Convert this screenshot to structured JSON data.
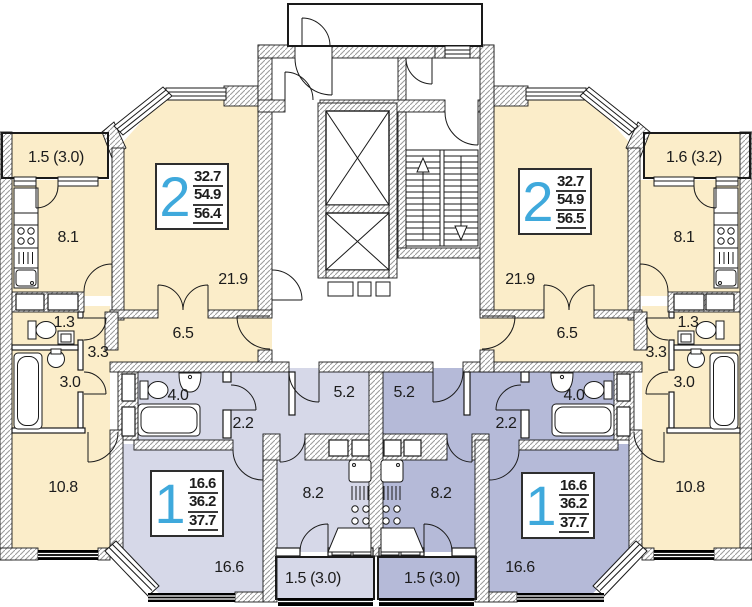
{
  "colors": {
    "apartment_2room": "#FBEDC9",
    "apartment_1room_left": "#D6D8E8",
    "apartment_1room_right": "#B5BAD8",
    "apartment_number_blue": "#3FA9DC"
  },
  "apartments": [
    {
      "id": "two-room-left",
      "rooms_count": "2",
      "area_living": "32.7",
      "area_usable": "54.9",
      "area_total": "56.4"
    },
    {
      "id": "two-room-right",
      "rooms_count": "2",
      "area_living": "32.7",
      "area_usable": "54.9",
      "area_total": "56.5"
    },
    {
      "id": "one-room-left",
      "rooms_count": "1",
      "area_living": "16.6",
      "area_usable": "36.2",
      "area_total": "37.7"
    },
    {
      "id": "one-room-right",
      "rooms_count": "1",
      "area_living": "16.6",
      "area_usable": "36.2",
      "area_total": "37.7"
    }
  ],
  "labels": {
    "balcony_top_left": "1.5 (3.0)",
    "kitchen_top_left": "8.1",
    "living_top_left": "21.9",
    "hallway_top_left": "6.5",
    "wc_top_left": "1.3",
    "corridor_top_left": "3.3",
    "bathroom_top_left": "3.0",
    "room_bottom_left": "10.8",
    "bathroom_1room_left": "4.0",
    "hall_1room_left": "2.2",
    "entry_1room_left": "5.2",
    "kitchen_1room_left": "8.2",
    "room_1room_left": "16.6",
    "balcony_1room_left": "1.5 (3.0)",
    "balcony_top_right": "1.6 (3.2)",
    "kitchen_top_right": "8.1",
    "living_top_right": "21.9",
    "hallway_top_right": "6.5",
    "wc_top_right": "1.3",
    "corridor_top_right": "3.3",
    "bathroom_top_right": "3.0",
    "room_bottom_right": "10.8",
    "bathroom_1room_right": "4.0",
    "hall_1room_right": "2.2",
    "entry_1room_right": "5.2",
    "kitchen_1room_right": "8.2",
    "room_1room_right": "16.6",
    "balcony_1room_right": "1.5 (3.0)"
  }
}
